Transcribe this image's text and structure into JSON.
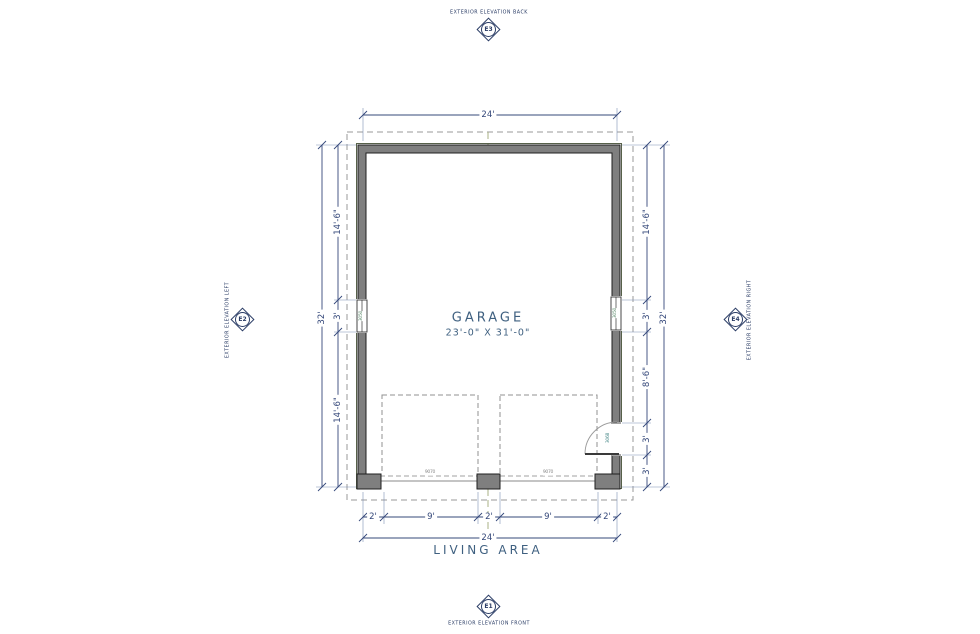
{
  "drawing": {
    "room": {
      "name": "GARAGE",
      "size": "23'-0\" X 31'-0\""
    },
    "area_label": "LIVING AREA"
  },
  "markers": {
    "top": {
      "id": "E3",
      "label": "EXTERIOR ELEVATION BACK"
    },
    "bottom": {
      "id": "E1",
      "label": "EXTERIOR ELEVATION FRONT"
    },
    "left": {
      "id": "E2",
      "label": "EXTERIOR ELEVATION LEFT"
    },
    "right": {
      "id": "E4",
      "label": "EXTERIOR ELEVATION RIGHT"
    }
  },
  "dimensions": {
    "top_overall": "24'",
    "bottom_overall": "24'",
    "left_overall": "32'",
    "right_overall": "32'",
    "left_chain": [
      "14'-6\"",
      "3'",
      "14'-6\""
    ],
    "right_chain": [
      "14'-6\"",
      "3'",
      "8'-6\"",
      "3'",
      "3'"
    ],
    "bottom_chain": [
      "2'",
      "9'",
      "2'",
      "9'",
      "2'"
    ]
  },
  "fixtures": {
    "garage_door_left": "9070",
    "garage_door_right": "9070",
    "window_left": "3050",
    "window_right": "3050",
    "entry_door": "3068"
  },
  "colors": {
    "dimension_blue": "#35487a",
    "label_blue": "#3f6080",
    "marker_navy": "#2b3d66",
    "wall_gray": "#7f7f7f",
    "overhang_gray": "#9a9a9a",
    "centerline_olive": "#a9b184"
  }
}
